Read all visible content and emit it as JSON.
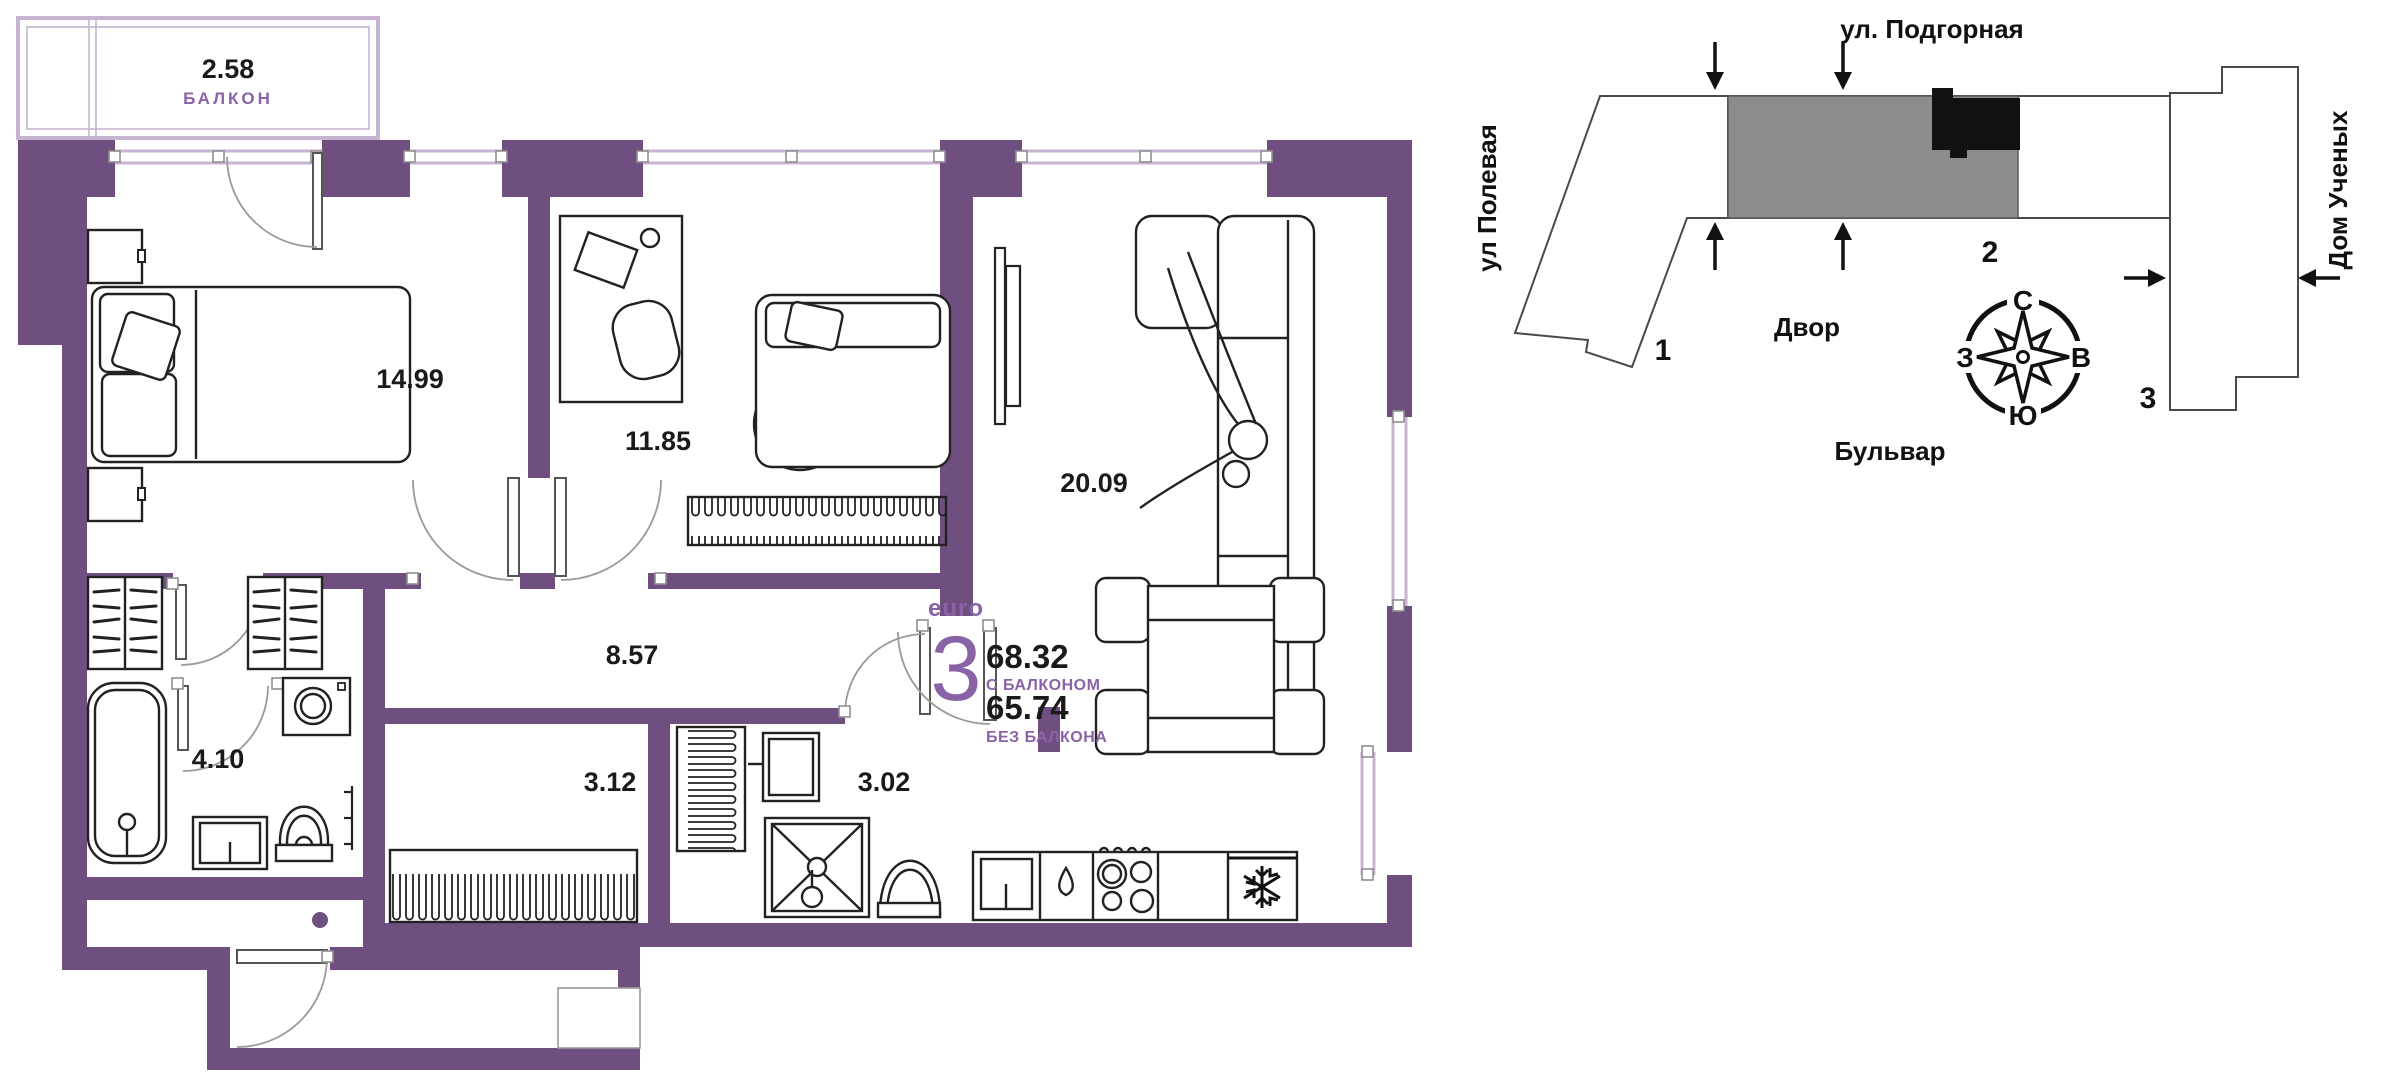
{
  "floor_plan": {
    "balcony": {
      "area": "2.58",
      "label": "БАЛКОН"
    },
    "rooms": [
      {
        "id": "bedroom-main",
        "area": "14.99"
      },
      {
        "id": "bedroom-second",
        "area": "11.85"
      },
      {
        "id": "living-kitchen",
        "area": "20.09"
      },
      {
        "id": "hallway",
        "area": "8.57"
      },
      {
        "id": "bathroom",
        "area": "4.10"
      },
      {
        "id": "wardrobe-room",
        "area": "3.12"
      },
      {
        "id": "shower-room",
        "area": "3.02"
      }
    ],
    "summary": {
      "type_label": "euro",
      "rooms_count": "3",
      "area_with_balcony": "68.32",
      "with_balcony_label": "С БАЛКОНОМ",
      "area_without_balcony": "65.74",
      "without_balcony_label": "БЕЗ БАЛКОНА"
    }
  },
  "site_plan": {
    "streets": {
      "top": "ул. Подгорная",
      "left": "ул Полевая",
      "right": "Дом Ученых",
      "bottom": "Бульвар",
      "courtyard": "Двор"
    },
    "buildings": [
      {
        "label": "1"
      },
      {
        "label": "2"
      },
      {
        "label": "3"
      }
    ],
    "compass": {
      "north": "С",
      "south": "Ю",
      "west": "З",
      "east": "В"
    }
  },
  "colors": {
    "wall": "#6f4f80",
    "light_purple": "#c6b4d2",
    "accent_text": "#8a62a6",
    "site_building_gray": "#8c8c8c",
    "site_building_black": "#111111"
  }
}
